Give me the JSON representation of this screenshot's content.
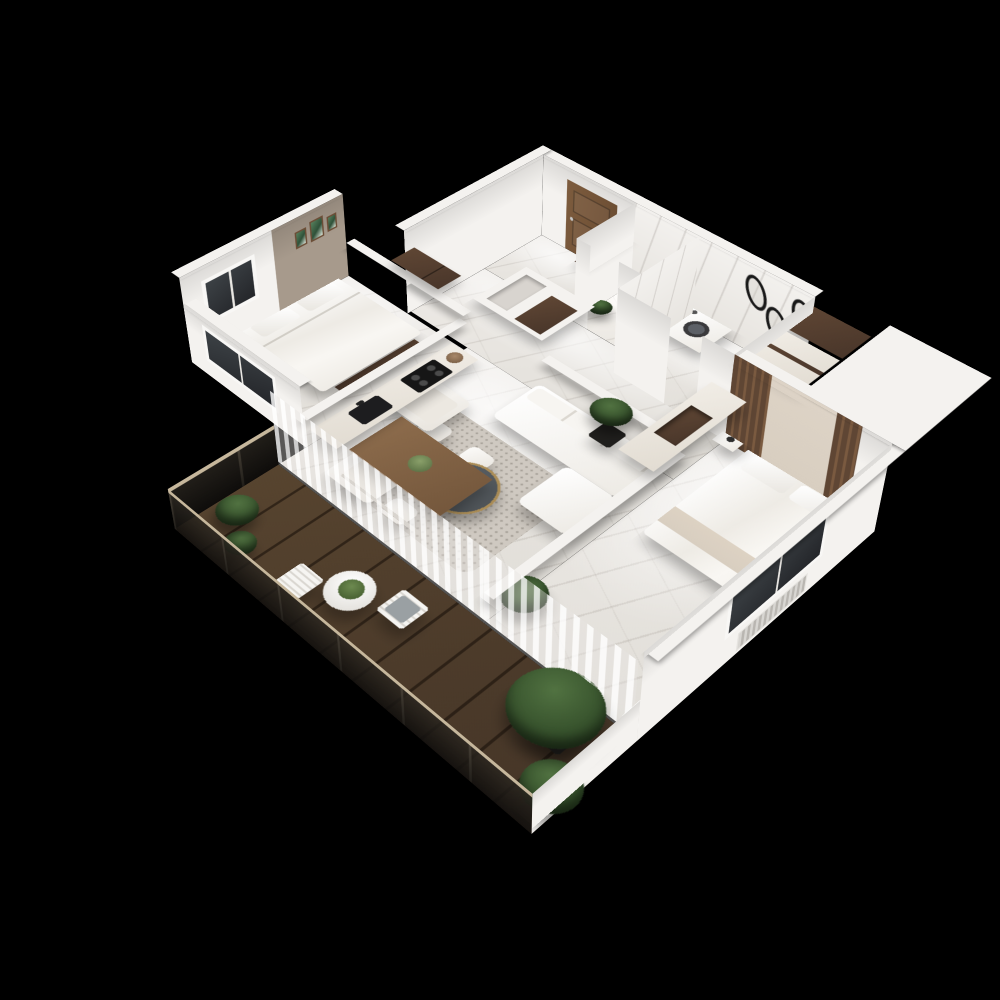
{
  "scene": {
    "type": "3d-floor-plan-render",
    "style": "isometric dollhouse cutaway of a two-bedroom apartment with balcony",
    "background": "#000000",
    "floor_material": "white marble with gray veining",
    "deck_material": "dark wood planks"
  },
  "palette": {
    "bg": "#000000",
    "wall": "#f4f2ef",
    "wallsh": "#e2dfda",
    "taupe": "#a79a8c",
    "mA": "#eeebe7",
    "mB": "#e0ddd7",
    "walnut": "#5f4634",
    "walnutD": "#49362a",
    "doorw": "#7d5c3e",
    "deckA": "#57442f",
    "deckB": "#453527",
    "tan": "#c6b79c",
    "glass": "#24262a",
    "sofa": "#f3f1ec",
    "rug": "#cfc9c1",
    "wood": "#8d6c4c",
    "charcoal": "#4b5054",
    "gold": "#ab8d57",
    "leaf": "#35502b",
    "leafD": "#20351a",
    "beige": "#d8cec0",
    "cushion": "#9aa0a3"
  },
  "rooms": [
    {
      "name": "Bedroom 1",
      "furniture": [
        "double bed with white bedding",
        "dark bench at bed foot",
        "walnut wardrobe",
        "3 framed botanical prints on taupe wall",
        "window"
      ]
    },
    {
      "name": "Entry Hall",
      "furniture": [
        "wooden front door",
        "dark coat panel"
      ]
    },
    {
      "name": "WC",
      "furniture": [
        "toilet",
        "potted plant",
        "marble walls"
      ]
    },
    {
      "name": "Bathroom",
      "furniture": [
        "washing machine",
        "walnut vanity with round sink",
        "3 oval black mirrors",
        "marble walls"
      ]
    },
    {
      "name": "Hallway",
      "furniture": [
        "storage block with niches",
        "walnut insert",
        "tall walnut and cream cabinets",
        "leaning mirror"
      ]
    },
    {
      "name": "Bedroom 2",
      "furniture": [
        "double bed",
        "slatted wood and beige headboard wall",
        "cream wardrobe with walnut niche",
        "bedside table",
        "monstera plant",
        "window with radiator",
        "sheer curtain"
      ]
    },
    {
      "name": "Kitchen",
      "furniture": [
        "cream counter run",
        "black sink with faucet",
        "4-burner gas hob",
        "pot"
      ]
    },
    {
      "name": "Dining Area",
      "furniture": [
        "rectangular wooden table",
        "4 white chairs",
        "table plant"
      ]
    },
    {
      "name": "Living Room",
      "furniture": [
        "white corner sofa with chaise",
        "2 white armchairs",
        "round charcoal coffee table with gold base",
        "speckled shag rug",
        "potted plant",
        "sheer curtains to balcony"
      ]
    },
    {
      "name": "Balcony",
      "furniture": [
        "dark wood deck",
        "glass balustrade with tan rails",
        "white parapet",
        "round bistro table with plant",
        "2 white slatted chairs (one with gray cushion)",
        "large potted shrubs"
      ]
    }
  ]
}
